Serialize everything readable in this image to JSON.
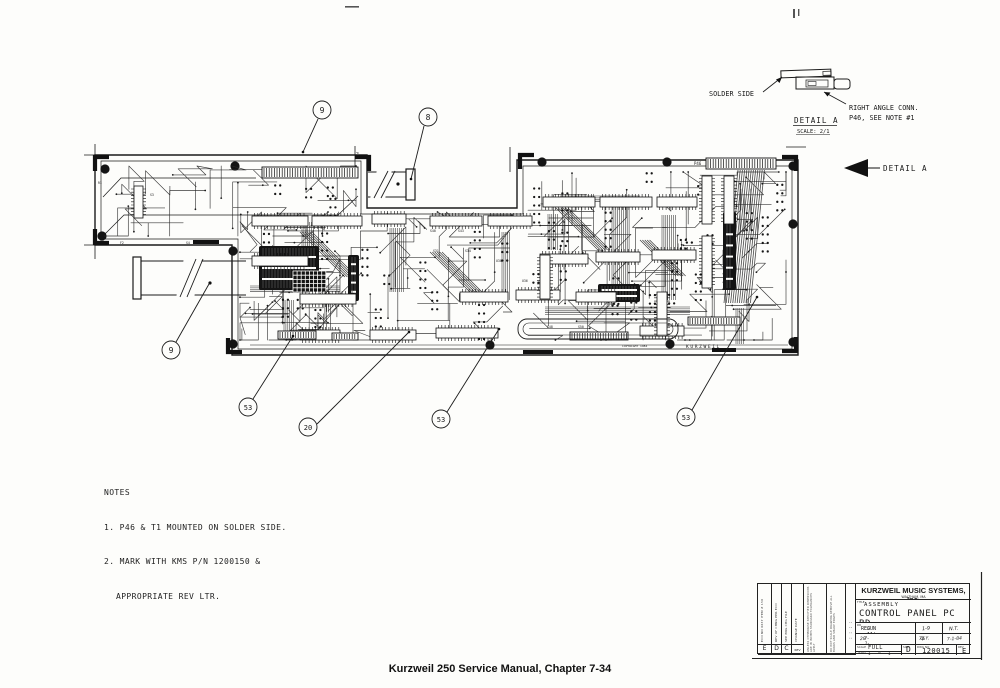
{
  "caption": "Kurzweil 250 Service Manual, Chapter 7-34",
  "detail_a": {
    "solder_side_label": "SOLDER SIDE",
    "conn_label_line1": "RIGHT ANGLE CONN.",
    "conn_label_line2": "P46, SEE NOTE #1",
    "title": "DETAIL A",
    "scale": "SCALE: 2/1",
    "pointer_label": "DETAIL A"
  },
  "notes": {
    "heading": "NOTES",
    "line1": "1. P46 & T1 MOUNTED ON SOLDER SIDE.",
    "line2": "2. MARK WITH KMS P/N 1200150 &",
    "line3": "APPROPRIATE REV LTR."
  },
  "callouts": [
    {
      "label": "9"
    },
    {
      "label": "8"
    },
    {
      "label": "9"
    },
    {
      "label": "53"
    },
    {
      "label": "20"
    },
    {
      "label": "53"
    },
    {
      "label": "53"
    }
  ],
  "board_labels": {
    "p46": "P46",
    "p52": "P52",
    "kurzweil": "KURZWEIL",
    "copyright": "COPYRIGHT 1984",
    "refdes": [
      "R1",
      "S3",
      "S4",
      "F2",
      "S31",
      "S34",
      "U30",
      "U33",
      "U36",
      "S38",
      "S40",
      "S43",
      "U22",
      "S48",
      "S50"
    ]
  },
  "title_block": {
    "company": "KURZWEIL MUSIC SYSTEMS, Inc.",
    "city": "WALTHAM, MA",
    "title_label": "TITLE",
    "assembly": "ASSEMBLY",
    "title": "CONTROL PANEL PC BD",
    "drawn_label": "DR",
    "drawn": "REG",
    "drawn_date": "JUN 11' 84",
    "checked_sig": "1-9",
    "approved_sig": "N.T.",
    "eng_no": "28",
    "eng_date": "7-1-84",
    "qa_no": "76",
    "qa_sig": "Q.Y.",
    "rel_date": "7-1-84",
    "scale_label": "SCALE",
    "scale": "FULL",
    "sheet_label": "SHEET",
    "sheet": "1",
    "of_label": "OF",
    "of": "1",
    "size_label": "SIZE",
    "size": "D",
    "dwg_label": "DWG NO",
    "dwg_no": "120015",
    "rev_label": "REV",
    "rev": "E",
    "rev_cols": [
      {
        "letter": "E",
        "text": "ECO NO 0637  ITEM # 150"
      },
      {
        "letter": "D",
        "text": "REV OF CHNG PER ECO"
      },
      {
        "letter": "C",
        "text": "SEE ENG CHG FILE"
      },
      {
        "letter": "REV",
        "text": "CHANGE   DATE"
      }
    ],
    "tol_col1": "UNLESS OTHERWISE SPECIFIED DIMENSIONS ARE IN INCHES STANDARD TOLERANCES APPLY",
    "tol_col2": "DO NOT SCALE DRAWING REMOVE ALL BURRS AND SHARP EDGES",
    "dots": ": : : :"
  }
}
